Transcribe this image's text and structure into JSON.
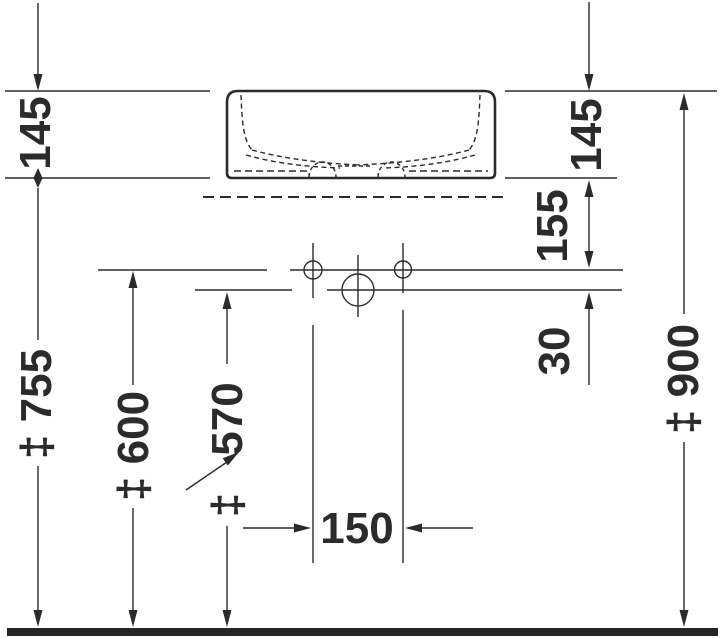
{
  "drawing": {
    "colors": {
      "ink": "#2b2b2b",
      "floor": "#262626",
      "background": "#ffffff"
    },
    "dimension_labels": {
      "basin_height_left": "145",
      "basin_height_right": "145",
      "rim_bottom_to_hole_line": "155",
      "hole_line_offset": "30",
      "hole_spacing": "150",
      "basin_underside_height": "‡ 755",
      "upper_hole_line_height": "‡ 600",
      "lower_hole_line_prefix": "‡",
      "lower_hole_line_value": "570",
      "rim_top_height": "‡ 900"
    }
  }
}
